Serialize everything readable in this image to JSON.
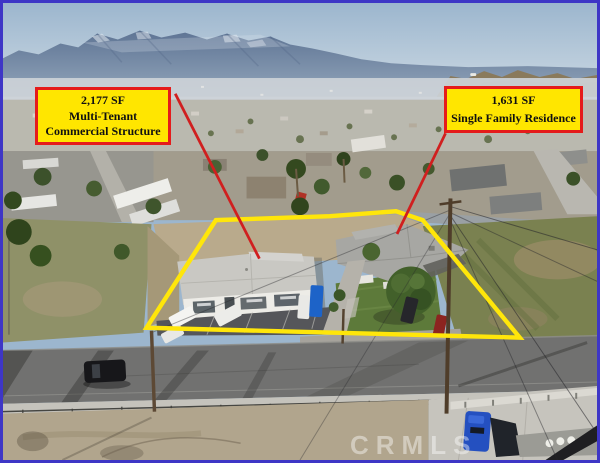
{
  "frame": {
    "border_color": "#3e36c6"
  },
  "labels": {
    "commercial": {
      "lines": [
        "2,177 SF",
        "Multi-Tenant",
        "Commercial Structure"
      ]
    },
    "residence": {
      "lines": [
        "1,631 SF",
        "Single Family Residence"
      ]
    }
  },
  "annotations": {
    "parcel_outline_color": "#ffe60a",
    "arrow_color": "#d01f1f",
    "label_background": "#ffe600",
    "label_border_color": "#e51b1b"
  },
  "watermark": {
    "text": "CRMLS",
    "color": "#ffffff"
  }
}
